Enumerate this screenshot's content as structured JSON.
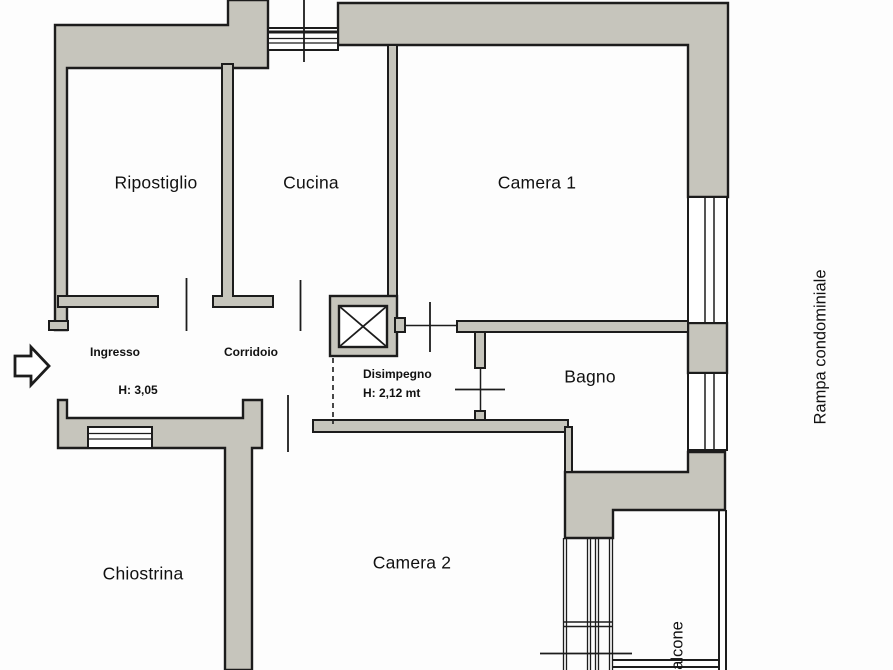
{
  "canvas": {
    "width": 893,
    "height": 670
  },
  "colors": {
    "wall_fill": "#c6c5bc",
    "line": "#1c1c1c",
    "background": "#fdfdfd"
  },
  "rooms": {
    "ripostiglio": {
      "label": "Ripostiglio"
    },
    "cucina": {
      "label": "Cucina"
    },
    "camera1": {
      "label": "Camera 1"
    },
    "ingresso": {
      "label": "Ingresso",
      "height_note": "H: 3,05"
    },
    "corridoio": {
      "label": "Corridoio"
    },
    "disimpegno": {
      "label": "Disimpegno",
      "height_note": "H: 2,12 mt"
    },
    "bagno": {
      "label": "Bagno"
    },
    "camera2": {
      "label": "Camera 2"
    },
    "chiostrina": {
      "label": "Chiostrina"
    },
    "balcone": {
      "label": "Balcone"
    },
    "rampa_condominiale": {
      "label": "Rampa condominiale"
    }
  },
  "icons": {
    "entrance_arrow": "right-block-arrow",
    "elevator": "crossed-box-lift-shaft"
  }
}
